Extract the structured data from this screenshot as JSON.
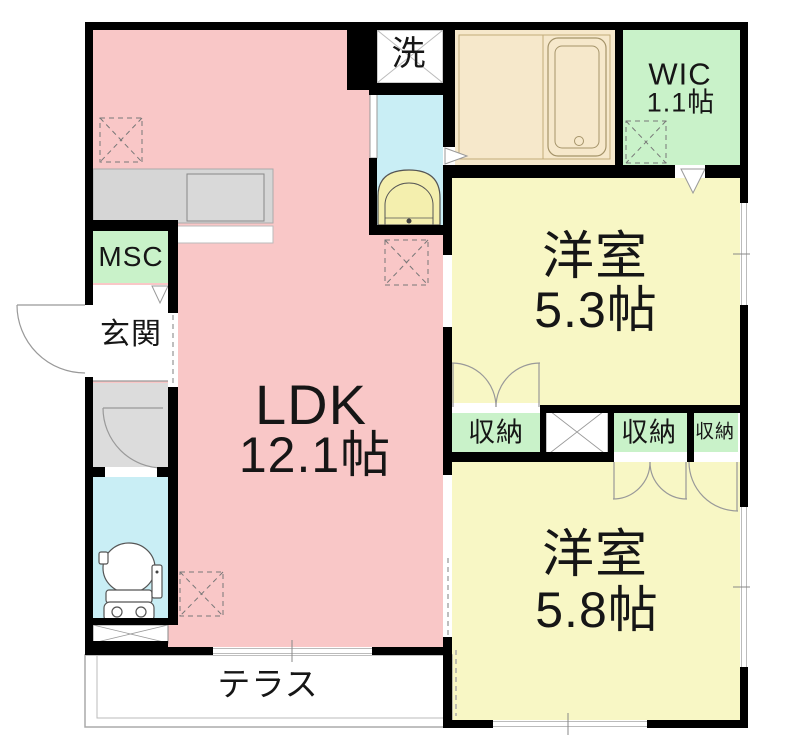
{
  "floorplan": {
    "ldk": {
      "name": "LDK",
      "size": "12.1帖"
    },
    "bedroom_upper": {
      "name": "洋室",
      "size": "5.3帖"
    },
    "bedroom_lower": {
      "name": "洋室",
      "size": "5.8帖"
    },
    "wic": {
      "name": "WIC",
      "size": "1.1帖"
    },
    "msc": {
      "name": "MSC"
    },
    "entrance": {
      "name": "玄関"
    },
    "laundry": {
      "name": "洗"
    },
    "storage_left": {
      "name": "収納"
    },
    "storage_middle": {
      "name": "収納"
    },
    "storage_right": {
      "name": "収納"
    },
    "terrace": {
      "name": "テラス"
    }
  },
  "colors": {
    "ldk_fill": "#f9c7c7",
    "bedroom_fill": "#f8f7c5",
    "closet_green": "#c9f2c9",
    "sanitary_cyan": "#c9eef5",
    "bathroom_beige": "#f6e8cb",
    "hall_gray": "#dcdcdc",
    "counter_gray": "#d6d6d6",
    "wall_black": "#000000",
    "line_gray": "#999999"
  }
}
